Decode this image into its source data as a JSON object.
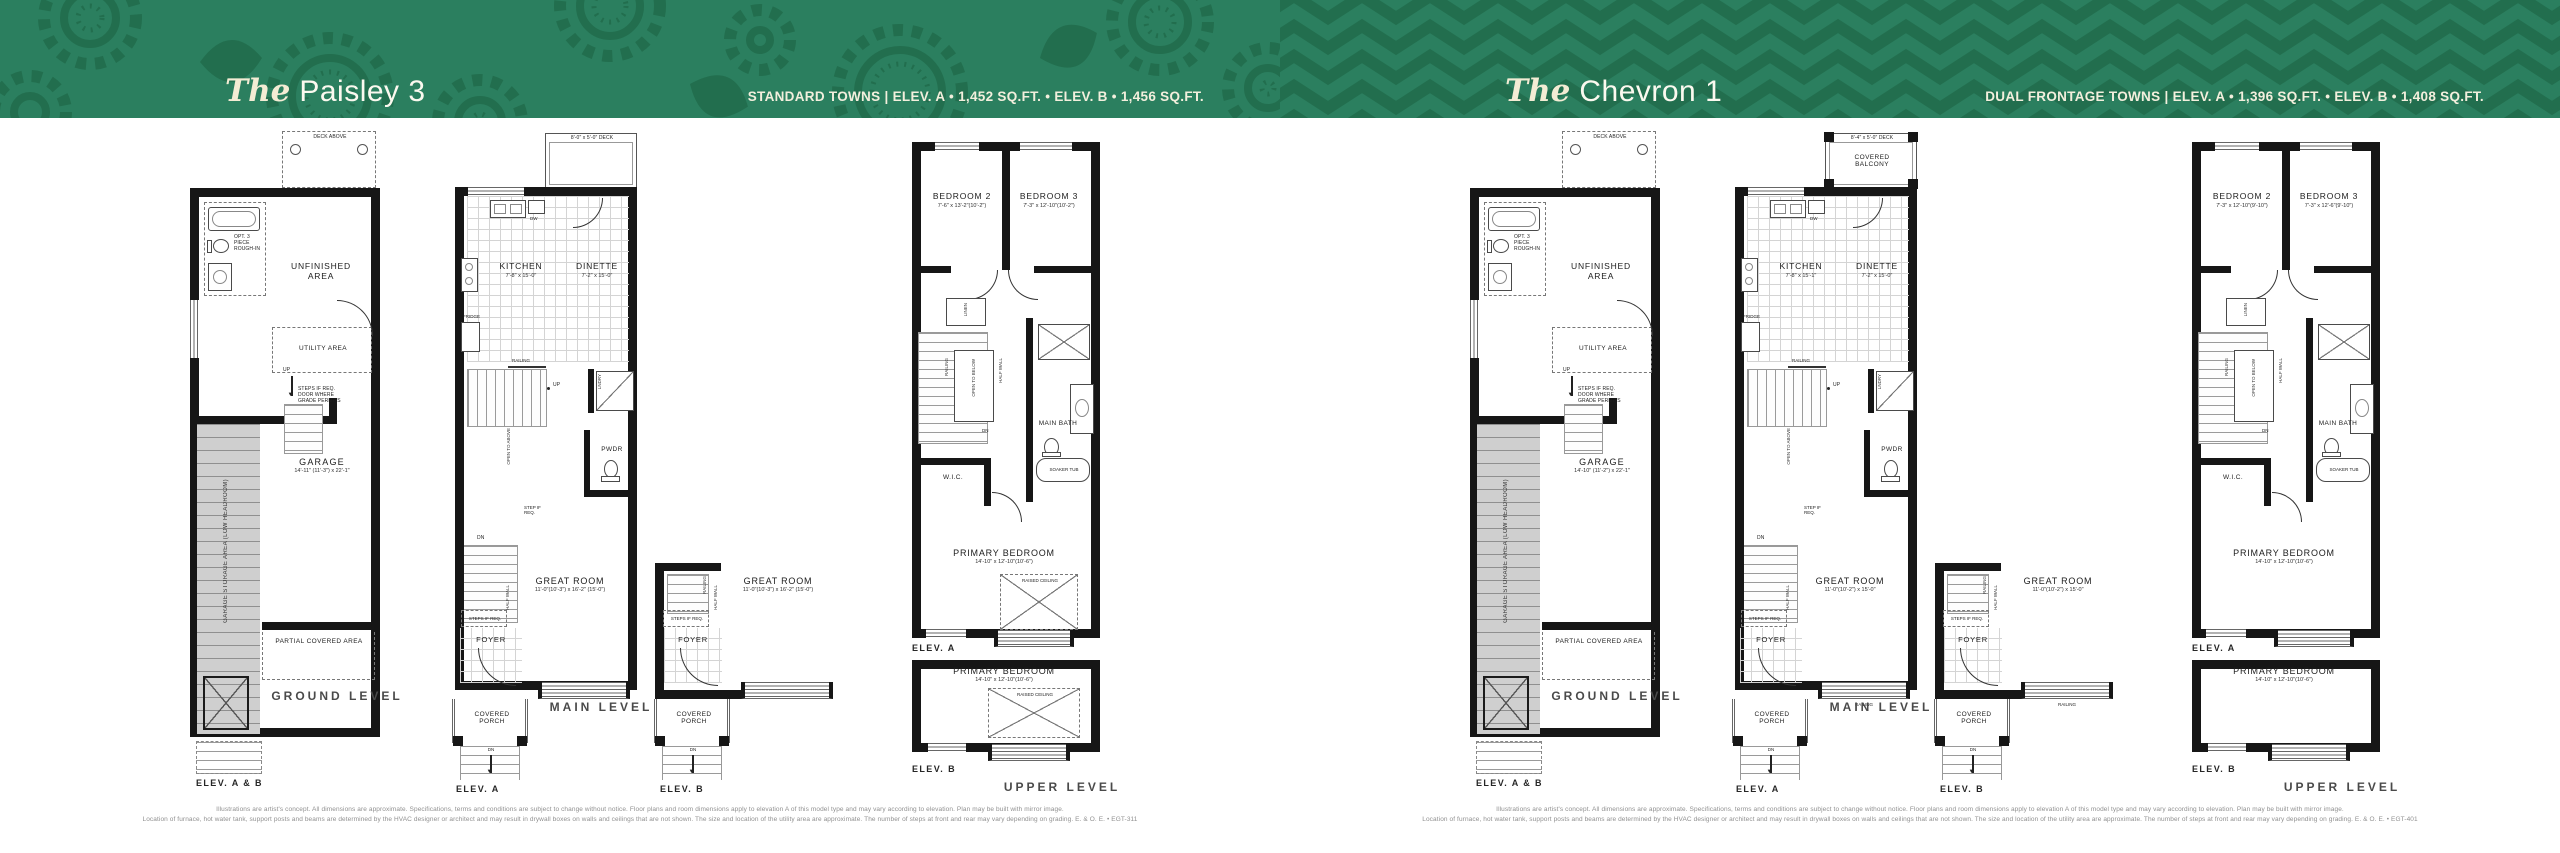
{
  "header": {
    "left": {
      "article": "The",
      "name": "Paisley 3",
      "subtitle": "STANDARD TOWNS | ELEV. A • 1,452 SQ.FT. • ELEV. B • 1,456 SQ.FT."
    },
    "right": {
      "article": "The",
      "name": "Chevron 1",
      "subtitle": "DUAL FRONTAGE TOWNS | ELEV. A • 1,396 SQ.FT. • ELEV. B • 1,408 SQ.FT."
    }
  },
  "colors": {
    "header_green": "#2b7f5f",
    "pattern_green": "#226e4e",
    "title_cream": "#f3ecd4",
    "wall_black": "#161616",
    "hatch_gray": "#cfcfcf"
  },
  "common": {
    "deck_above": "DECK ABOVE",
    "opt_rough_in": "OPT. 3 PIECE ROUGH-IN",
    "unfinished_area": "UNFINISHED AREA",
    "utility_area": "UTILITY AREA",
    "up": "UP",
    "dn": "DN",
    "steps_note": "STEPS IF REQ. DOOR WHERE GRADE PERMITS",
    "garage": "GARAGE",
    "garage_storage": "GARAGE STORAGE AREA (LOW HEADROOM)",
    "partial_covered": "PARTIAL COVERED AREA",
    "ground_level": "GROUND LEVEL",
    "elev_ab": "ELEV. A & B",
    "kitchen": "KITCHEN",
    "dinette": "DINETTE",
    "dw": "DW",
    "fridge": "FRIDGE",
    "railing": "RAILING",
    "lndry": "LNDRY",
    "wd": "W/D",
    "open_to_above": "OPEN TO ABOVE",
    "open_to_below": "OPEN TO BELOW",
    "pwdr": "PWDR",
    "step_if_req": "STEP IF REQ.",
    "steps_if_req": "STEPS IF REQ.",
    "great_room": "GREAT ROOM",
    "half_wall": "HALF WALL",
    "foyer": "FOYER",
    "covered_porch": "COVERED PORCH",
    "covered_balcony": "COVERED BALCONY",
    "main_level": "MAIN LEVEL",
    "elev_a": "ELEV. A",
    "elev_b": "ELEV. B",
    "bedroom2": "BEDROOM 2",
    "bedroom3": "BEDROOM 3",
    "linen": "LINEN",
    "main_bath": "MAIN BATH",
    "soaker_tub": "SOAKER TUB",
    "wic": "W.I.C.",
    "primary_bedroom": "PRIMARY BEDROOM",
    "raised_ceiling": "RAISED CEILING",
    "upper_level": "UPPER LEVEL"
  },
  "paisley": {
    "dims": {
      "deck": "8'-0\" x 5'-0\" DECK",
      "kitchen": "7'-8\" x 15'-0\"",
      "dinette": "7'-2\" x 15'-0\"",
      "great_room": "11'-0\"(10'-3\") x 16'-2\" (15'-0\")",
      "garage": "14'-11\" (11'-3\") x 22'-1\"",
      "bedroom2": "7'-6\" x 13'-2\"(10'-2\")",
      "bedroom3": "7'-3\" x 12'-10\"(10'-2\")",
      "primary": "14'-10\" x 12'-10\"(10'-6\")"
    },
    "disclaimer1": "Illustrations are artist's concept. All dimensions are approximate. Specifications, terms and conditions are subject to change without notice. Floor plans and room dimensions apply to elevation A of this model type and may vary according to elevation. Plan may be built with mirror image.",
    "disclaimer2": "Location of furnace, hot water tank, support posts and beams are determined by the HVAC designer or architect and may result in drywall boxes on walls and ceilings that are not shown. The size and location of the utility area are approximate. The number of steps at front and rear may vary depending on grading. E. & O. E. • EGT-311"
  },
  "chevron": {
    "dims": {
      "deck": "8'-4\" x 5'-0\" DECK",
      "kitchen": "7'-8\" x 15'-1\"",
      "dinette": "7'-2\" x 15'-0\"",
      "great_room": "11'-0\"(10'-2\") x 15'-0\"",
      "garage": "14'-10\" (11'-2\") x 22'-1\"",
      "bedroom2": "7'-3\" x 12'-10\"(9'-10\")",
      "bedroom3": "7'-3\" x 12'-6\"(9'-10\")",
      "primary": "14'-10\" x 12'-10\"(10'-6\")"
    },
    "disclaimer1": "Illustrations are artist's concept. All dimensions are approximate. Specifications, terms and conditions are subject to change without notice. Floor plans and room dimensions apply to elevation A of this model type and may vary according to elevation. Plan may be built with mirror image.",
    "disclaimer2": "Location of furnace, hot water tank, support posts and beams are determined by the HVAC designer or architect and may result in drywall boxes on walls and ceilings that are not shown. The size and location of the utility area are approximate. The number of steps at front and rear may vary depending on grading. E. & O. E. • EGT-401"
  }
}
